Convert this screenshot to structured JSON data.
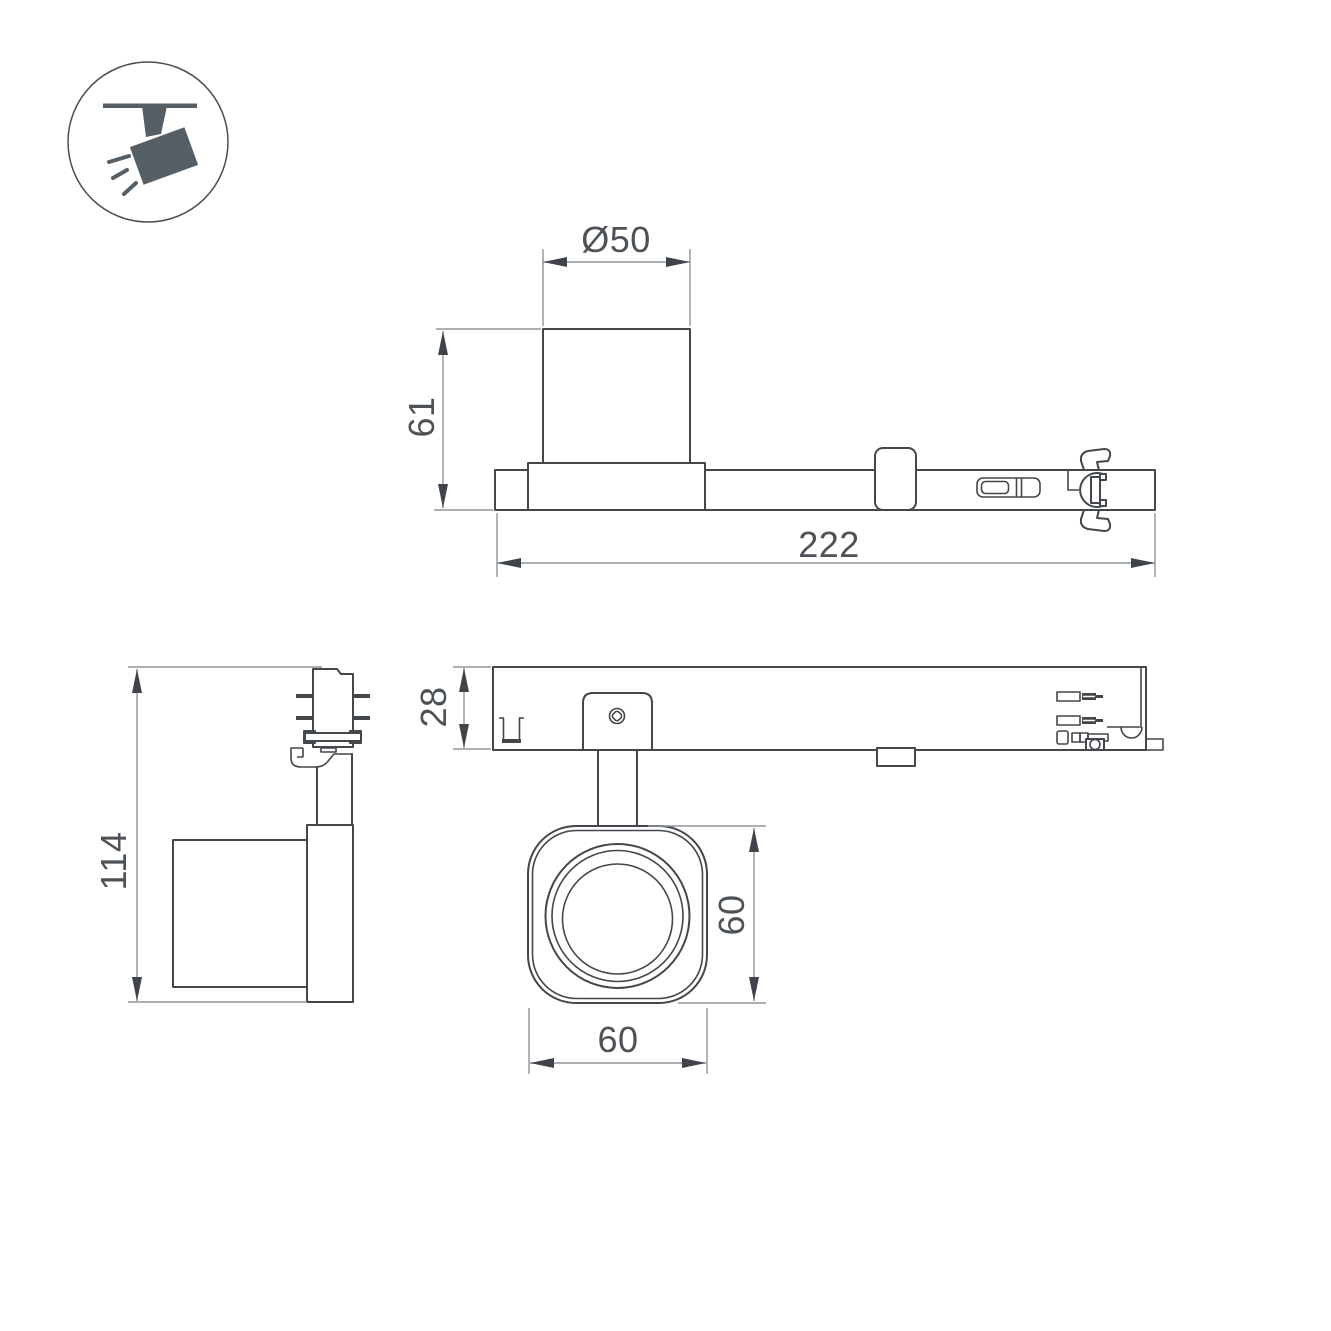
{
  "drawing": {
    "title": "track-spotlight-dimension-drawing",
    "background": "#ffffff",
    "object_line_color": "#42474c",
    "dimension_line_color": "#8f959b",
    "text_color": "#4d5257",
    "icon_color": "#575f66"
  },
  "legend_icon": {
    "name": "ceiling-track-spotlight"
  },
  "views": {
    "side_view": {
      "dims": {
        "lens_diameter": "Ø50",
        "body_height": "61",
        "total_length": "222"
      }
    },
    "front_view": {
      "dims": {
        "overall_height": "114"
      }
    },
    "bottom_view": {
      "dims": {
        "track_depth": "28",
        "head_height": "60",
        "head_width": "60"
      }
    }
  }
}
